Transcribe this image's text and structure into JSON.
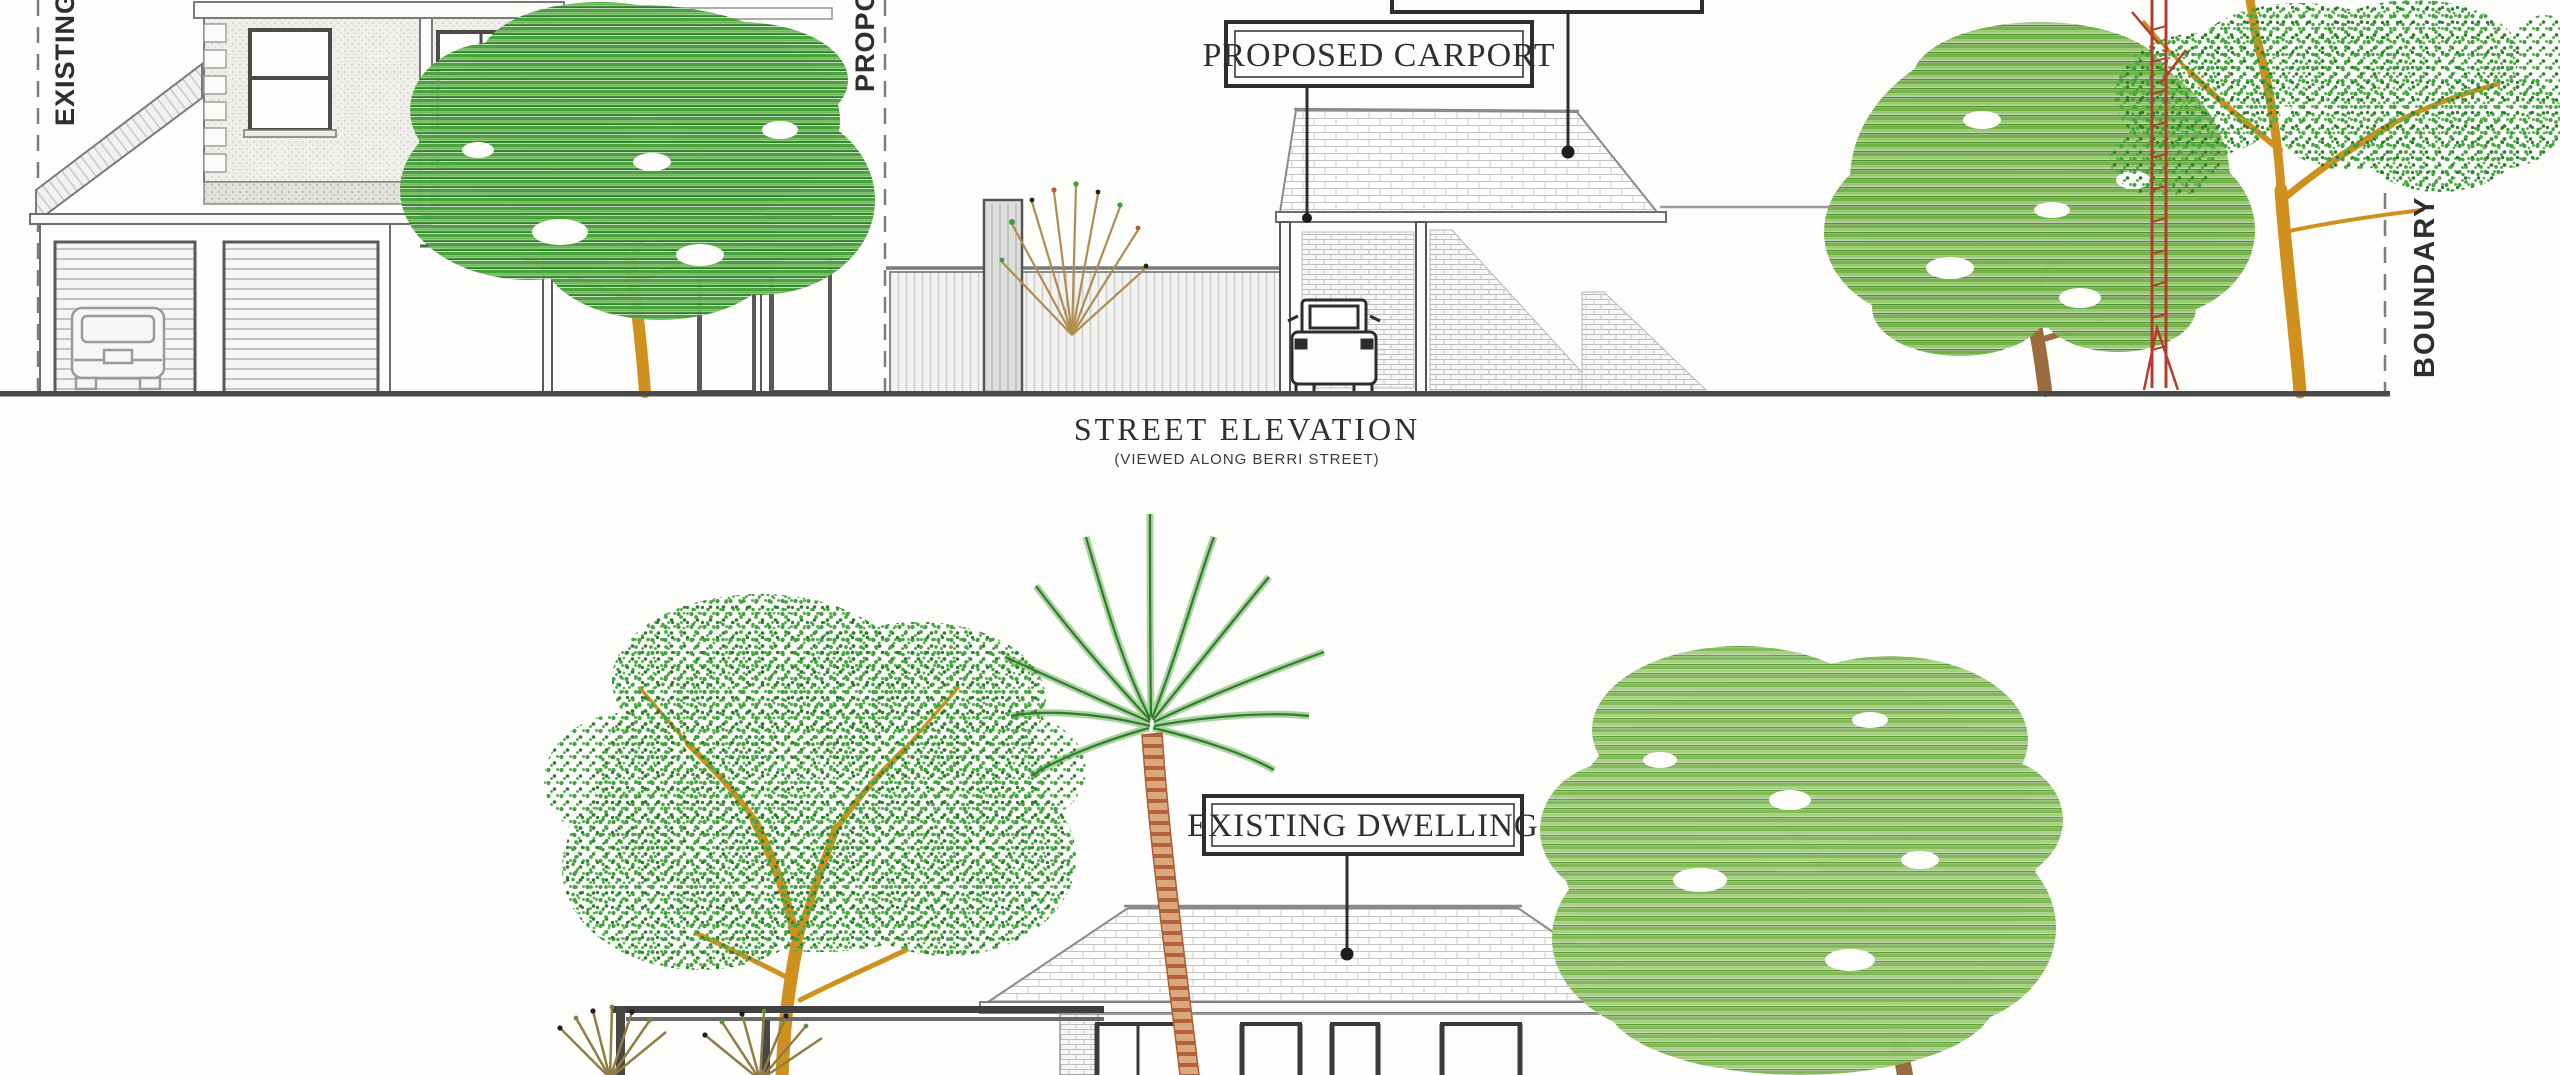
{
  "document": {
    "type": "scanned architectural elevation drawing",
    "title": "STREET ELEVATION",
    "subtitle": "(VIEWED ALONG BERRI STREET)"
  },
  "annotations": {
    "existing_line_label": "EXISTING",
    "proposed_line_label": "PROPOSED",
    "boundary_line_label": "BOUNDARY",
    "carport_label": "PROPOSED CARPORT",
    "dwelling_label": "EXISTING DWELLING",
    "clipped_top_label": ""
  },
  "scene": {
    "top_elevation": {
      "caption": "STREET ELEVATION",
      "elements": [
        "existing two-storey dwelling with double garage and car",
        "skillion roof over garage",
        "dashed existing line",
        "dashed proposed line",
        "corrugated fence with gate",
        "bare shrub",
        "proposed carport with hip tiled roof",
        "utility vehicle under carport",
        "brick retaining wedges",
        "leader dots on roofs",
        "striped-crown tree with orange trunk",
        "striped-crown tree with brown trunk",
        "tall speckled tree with orange trunk",
        "red ladder-trunk sapling",
        "dashed boundary line",
        "ground line"
      ]
    },
    "bottom_elevation": {
      "caption": "EXISTING DWELLING",
      "elements": [
        "speckled-crown tree with orange trunk",
        "pergola beams and posts",
        "fan shrubs",
        "palm tree with striped curved trunk",
        "single-storey dwelling with hip tiled roof and dark framed windows",
        "striped-crown tree with brown gnarled trunk",
        "leader dot on roof"
      ]
    }
  },
  "colors": {
    "paper": "#fdfdfb",
    "ink": "#2e2e2e",
    "line_gray": "#8a8a8a",
    "hatch_gray": "#c2c2c0",
    "green_bright": "#49a23e",
    "green_dark": "#2e7f29",
    "green_sage": "#82ba55",
    "trunk_orange": "#d0901f",
    "trunk_brown": "#9a6b3e",
    "trunk_red": "#b63b2f",
    "palm_stripe": "#b3623a"
  }
}
